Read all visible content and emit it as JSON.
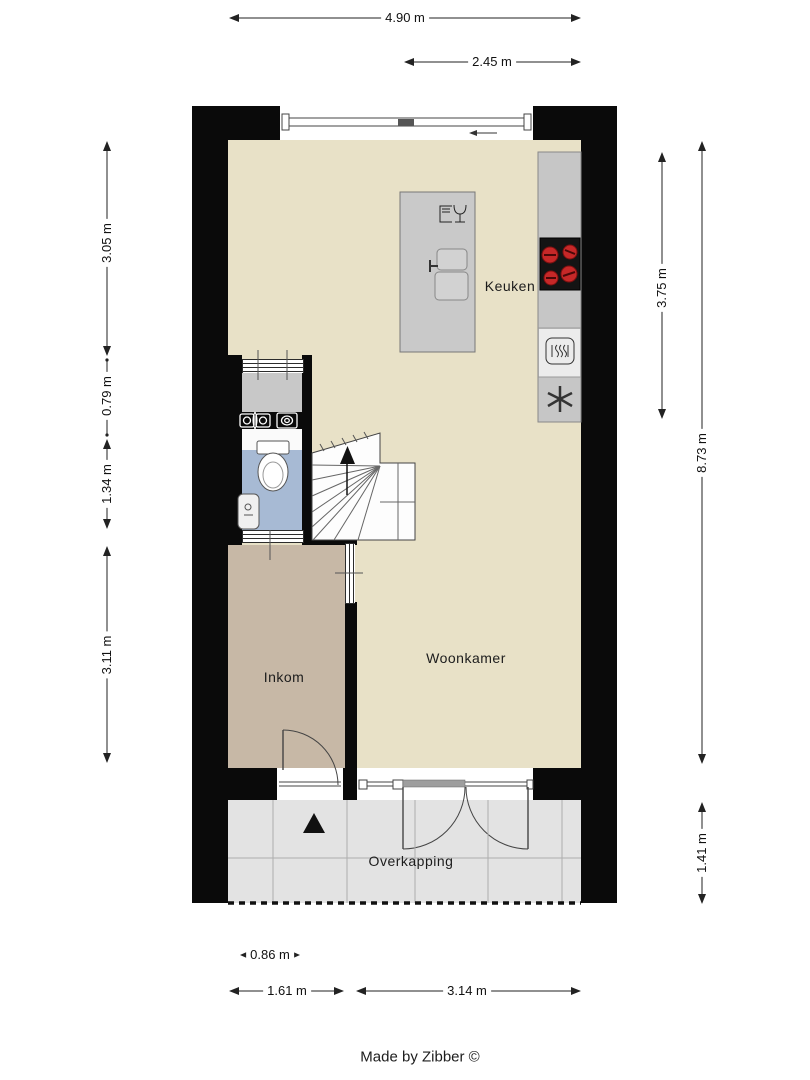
{
  "plan": {
    "type": "floorplan",
    "footer_credit": "Made by Zibber ©"
  },
  "rooms": {
    "kitchen": {
      "label": "Keuken"
    },
    "living": {
      "label": "Woonkamer"
    },
    "entrance": {
      "label": "Inkom"
    },
    "canopy": {
      "label": "Overkapping"
    }
  },
  "dimensions": {
    "top": [
      {
        "label": "4.90 m"
      },
      {
        "label": "2.45 m"
      }
    ],
    "left": [
      {
        "label": "3.05 m"
      },
      {
        "label": "0.79 m"
      },
      {
        "label": "1.34 m"
      },
      {
        "label": "3.11 m"
      }
    ],
    "right": [
      {
        "label": "3.75 m"
      },
      {
        "label": "8.73 m"
      },
      {
        "label": "1.41 m"
      }
    ],
    "bottom": [
      {
        "label": "0.86 m"
      },
      {
        "label": "1.61 m"
      },
      {
        "label": "3.14 m"
      }
    ]
  },
  "icons": {
    "stairs_direction": "up-arrow",
    "entrance_marker": "up-triangle",
    "sliding_window_direction": "left-arrow",
    "kitchen": [
      "dishwasher-icon",
      "double-sink-icon",
      "cooktop-icon",
      "oven-icon",
      "extractor-fan-icon"
    ],
    "sanitary": [
      "toilet-icon",
      "washbasin-icon",
      "washer-connection-icons"
    ]
  },
  "colors": {
    "wall": "#0a0a0a",
    "floor": "#e8e1c7",
    "entrance-floor": "#c7b8a6",
    "toilet-floor": "#a7bad4",
    "tech-floor": "#c8c8c8",
    "canopy-floor": "#e3e3e3",
    "counter": "#c6c6c6",
    "island": "#c9c9c9",
    "cooktop": "#141414",
    "burner": "#c62828"
  }
}
